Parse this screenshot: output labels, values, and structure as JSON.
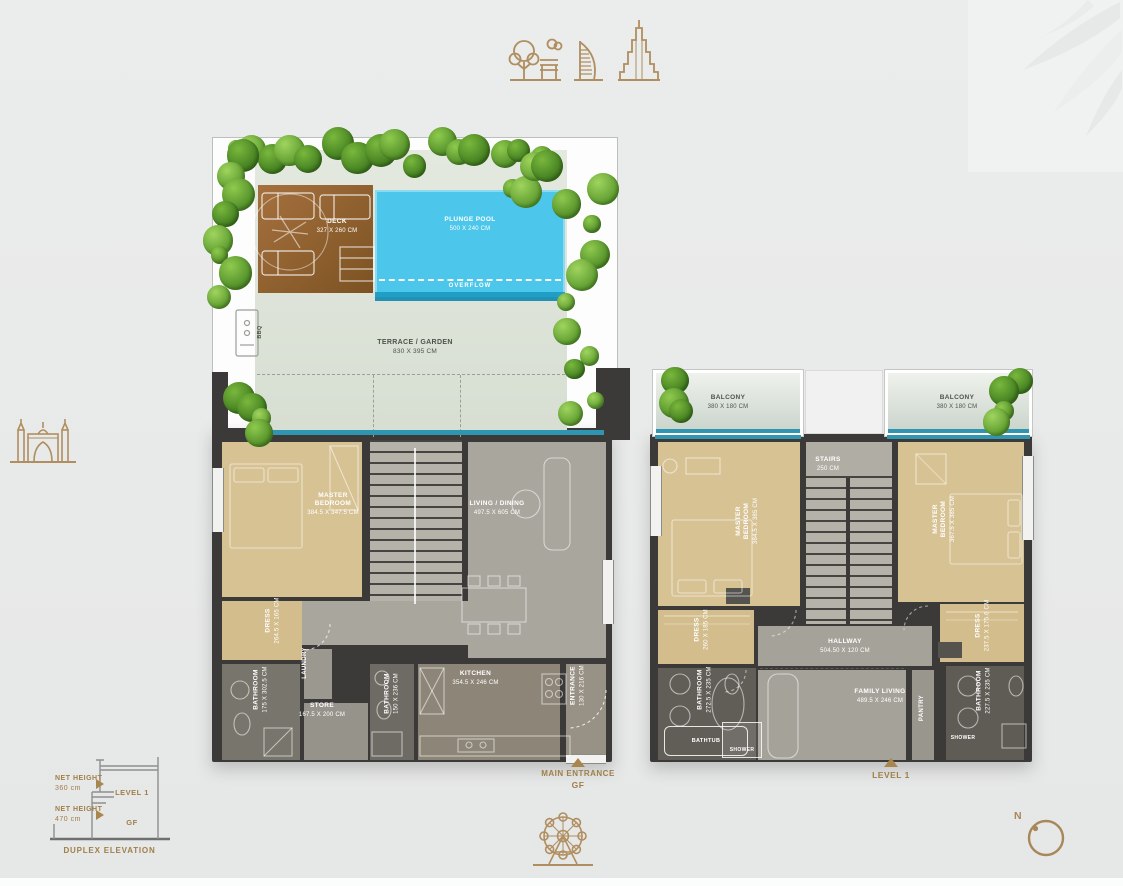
{
  "colors": {
    "gold": "#a8864e",
    "wall": "#3b3a38",
    "pool_blue": "#4cc6ea",
    "beige": "#d7c294",
    "floor_gray": "#a9a69e",
    "bath_gray": "#67645d",
    "terrace_green": "#dfe5da",
    "glass_teal": "#2f95b0"
  },
  "gf": {
    "garden": {
      "deck": {
        "name": "DECK",
        "dims": "327 x 260 cm"
      },
      "pool": {
        "name": "PLUNGE POOL",
        "dims": "500 x 240 cm",
        "overflow": "OVERFLOW"
      },
      "bbq": {
        "name": "BBQ"
      },
      "terrace": {
        "name": "TERRACE / GARDEN",
        "dims": "830 x 395 cm"
      }
    },
    "rooms": {
      "master_bedroom": {
        "name": "MASTER BEDROOM",
        "dims": "384.5 x 347.5 cm"
      },
      "living_dining": {
        "name": "LIVING / DINING",
        "dims": "497.5 x 605 cm"
      },
      "dress": {
        "name": "DRESS",
        "dims": "264.5 x 165 cm"
      },
      "bathroom_1": {
        "name": "BATHROOM",
        "dims": "175 x 302.5 cm"
      },
      "laundry": {
        "name": "LAUNDRY"
      },
      "store": {
        "name": "STORE",
        "dims": "167.5 x 200 cm"
      },
      "bathroom_2": {
        "name": "BATHROOM",
        "dims": "150 x 236 cm"
      },
      "kitchen": {
        "name": "KITCHEN",
        "dims": "354.5 x 246 cm"
      },
      "entrance": {
        "name": "ENTRANCE",
        "dims": "130 x 216 cm"
      }
    },
    "marker": {
      "line1": "MAIN ENTRANCE",
      "line2": "GF"
    }
  },
  "l1": {
    "rooms": {
      "balcony_left": {
        "name": "BALCONY",
        "dims": "380 x 180 cm"
      },
      "balcony_right": {
        "name": "BALCONY",
        "dims": "380 x 180 cm"
      },
      "stairs": {
        "name": "STAIRS",
        "dims": "250 cm"
      },
      "master_bedroom_left": {
        "name": "MASTER BEDROOM",
        "dims": "384.5 x 385 cm"
      },
      "master_bedroom_right": {
        "name": "MASTER BEDROOM",
        "dims": "367.5 x 385 cm"
      },
      "dress_left": {
        "name": "DRESS",
        "dims": "260 x 185 cm"
      },
      "bathroom_left": {
        "name": "BATHROOM",
        "dims": "272.5 x 235 cm"
      },
      "bathtub": {
        "name": "BATHTUB"
      },
      "shower_left": {
        "name": "SHOWER"
      },
      "hallway": {
        "name": "HALLWAY",
        "dims": "504.50 x 120 cm"
      },
      "family_living": {
        "name": "FAMILY LIVING",
        "dims": "489.5 x 246 cm"
      },
      "pantry": {
        "name": "PANTRY"
      },
      "dress_right": {
        "name": "DRESS",
        "dims": "237.5 x 175.6 cm"
      },
      "bathroom_right": {
        "name": "BATHROOM",
        "dims": "227.5 x 235 cm"
      },
      "shower_right": {
        "name": "SHOWER"
      }
    },
    "marker": {
      "line1": "LEVEL 1"
    }
  },
  "elevation": {
    "level1_height_label": "NET HEIGHT",
    "level1_height_value": "360 cm",
    "level1_name": "LEVEL 1",
    "gf_height_label": "NET HEIGHT",
    "gf_height_value": "470 cm",
    "gf_name": "GF",
    "caption": "DUPLEX ELEVATION"
  },
  "compass": {
    "north_label": "N"
  }
}
